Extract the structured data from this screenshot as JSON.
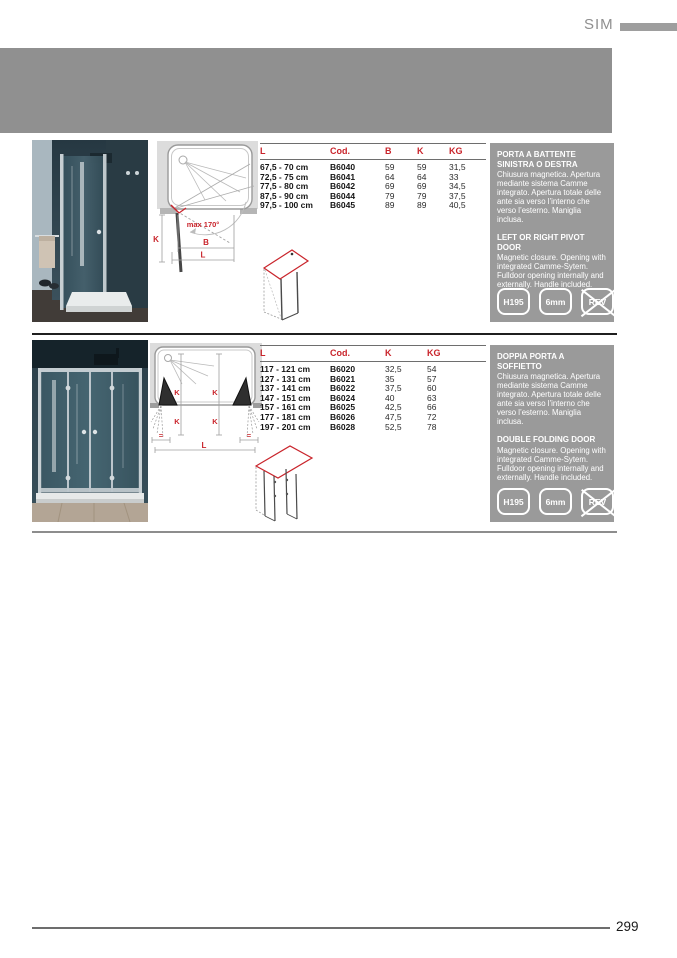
{
  "page": {
    "series": "SIM",
    "page_number": "299"
  },
  "palette": {
    "accent_red": "#c9242b",
    "band_gray": "#909090",
    "box_gray": "#9a9a9a",
    "photo_wall_teal": "#33464f",
    "photo_wall_light": "#a9b7bf",
    "floor_tan": "#b3a595"
  },
  "sections": [
    {
      "name": "pivot-door",
      "drawing": {
        "max_angle": "max 170°",
        "dim_k": "K",
        "dim_b": "B",
        "dim_l": "L"
      },
      "table": {
        "headers": [
          "L",
          "Cod.",
          "B",
          "K",
          "KG"
        ],
        "rows": [
          [
            "67,5 - 70 cm",
            "B6040",
            "59",
            "59",
            "31,5"
          ],
          [
            "72,5 - 75 cm",
            "B6041",
            "64",
            "64",
            "33"
          ],
          [
            "77,5 - 80 cm",
            "B6042",
            "69",
            "69",
            "34,5"
          ],
          [
            "87,5 - 90 cm",
            "B6044",
            "79",
            "79",
            "37,5"
          ],
          [
            "97,5 - 100 cm",
            "B6045",
            "89",
            "89",
            "40,5"
          ]
        ]
      },
      "description": {
        "title_it": "PORTA A BATTENTE SINISTRA O DESTRA",
        "body_it": "Chiusura magnetica. Apertura mediante sistema Camme integrato. Apertura totale delle ante sia verso l’interno che verso l’esterno. Maniglia inclusa.",
        "title_en": "LEFT OR RIGHT PIVOT DOOR",
        "body_en": "Magnetic closure. Opening with integrated Camme-Sytem. Fulldoor opening internally and externally. Handle included.",
        "badges": [
          {
            "label": "H195",
            "crossed": false
          },
          {
            "label": "6mm",
            "crossed": false
          },
          {
            "label": "REV",
            "crossed": true
          }
        ]
      }
    },
    {
      "name": "folding-door",
      "drawing": {
        "dim_k": "K",
        "dim_l": "L",
        "dim_eq": "="
      },
      "table": {
        "headers": [
          "L",
          "Cod.",
          "K",
          "KG"
        ],
        "rows": [
          [
            "117 - 121 cm",
            "B6020",
            "32,5",
            "54"
          ],
          [
            "127 - 131 cm",
            "B6021",
            "35",
            "57"
          ],
          [
            "137 - 141 cm",
            "B6022",
            "37,5",
            "60"
          ],
          [
            "147 - 151 cm",
            "B6024",
            "40",
            "63"
          ],
          [
            "157 - 161 cm",
            "B6025",
            "42,5",
            "66"
          ],
          [
            "177 - 181 cm",
            "B6026",
            "47,5",
            "72"
          ],
          [
            "197 - 201 cm",
            "B6028",
            "52,5",
            "78"
          ]
        ]
      },
      "description": {
        "title_it": "DOPPIA PORTA A SOFFIETTO",
        "body_it": "Chiusura magnetica. Apertura mediante sistema Camme integrato. Apertura totale delle ante sia verso l’interno che verso l’esterno. Maniglia inclusa.",
        "title_en": "DOUBLE FOLDING DOOR",
        "body_en": "Magnetic closure. Opening with integrated Camme-Sytem. Fulldoor opening internally and externally. Handle included.",
        "badges": [
          {
            "label": "H195",
            "crossed": false
          },
          {
            "label": "6mm",
            "crossed": false
          },
          {
            "label": "REV",
            "crossed": true
          }
        ]
      }
    }
  ]
}
